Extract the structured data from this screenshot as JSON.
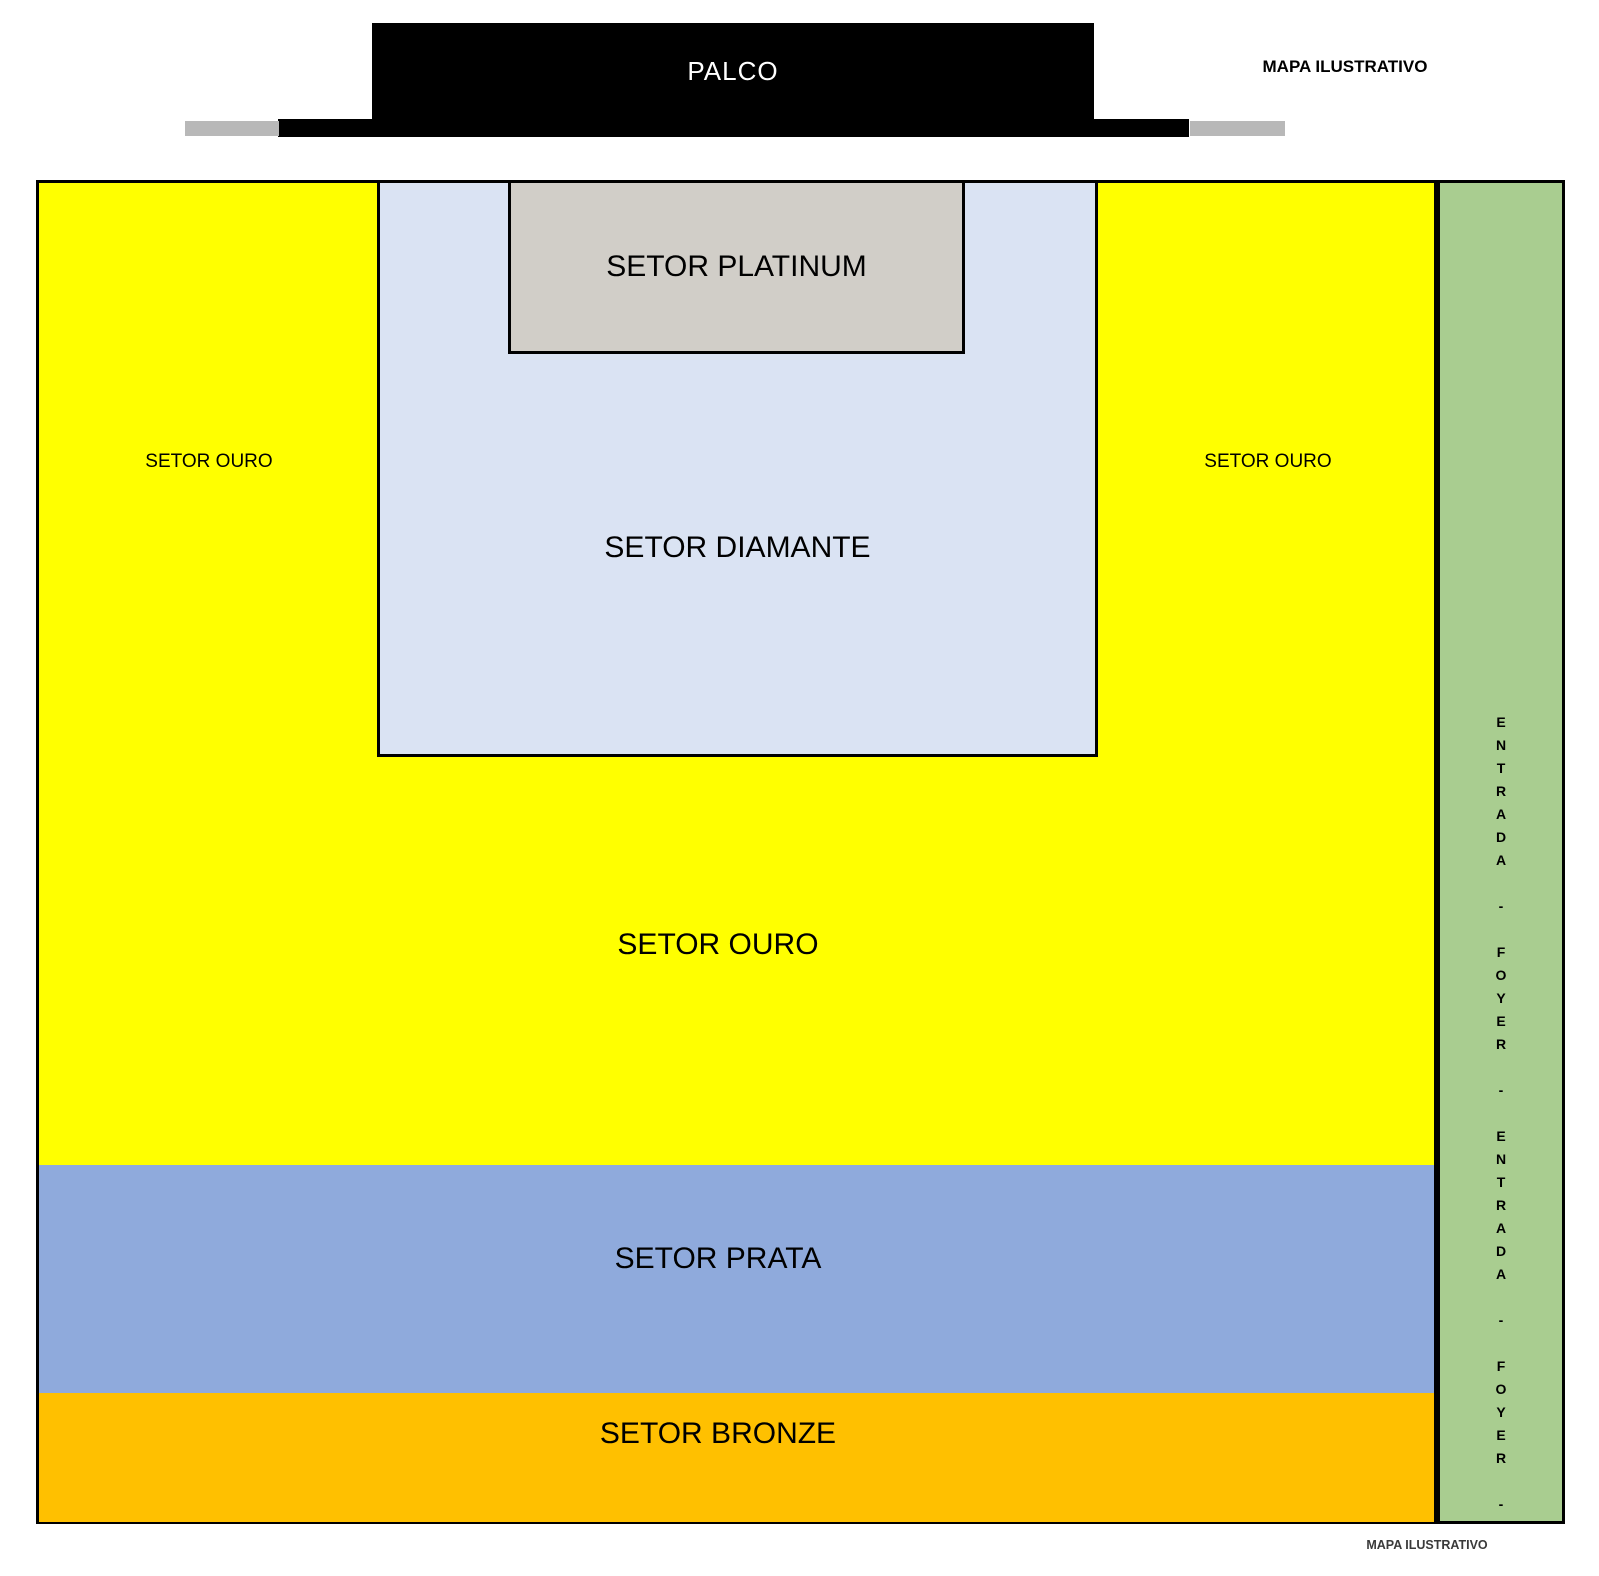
{
  "map_title_top": "MAPA ILUSTRATIVO",
  "map_title_bottom": "MAPA ILUSTRATIVO",
  "stage": {
    "label": "PALCO",
    "color": "#000000",
    "wing_color": "#b8b8b8"
  },
  "sectors": {
    "platinum": {
      "label": "SETOR PLATINUM",
      "color": "#d1cec8"
    },
    "diamante": {
      "label": "SETOR DIAMANTE",
      "color": "#dae3f3"
    },
    "ouro": {
      "label": "SETOR OURO",
      "color": "#ffff00"
    },
    "prata": {
      "label": "SETOR PRATA",
      "color": "#8faadc"
    },
    "bronze": {
      "label": "SETOR BRONZE",
      "color": "#ffc000"
    }
  },
  "ouro_side_labels": {
    "left": "SETOR OURO",
    "right": "SETOR OURO"
  },
  "entrance_strip": {
    "label": "ENTRADA - FOYER - ENTRADA - FOYER -",
    "vertical_text": "E\nN\nT\nR\nA\nD\nA\n \n-\n \nF\nO\nY\nE\nR\n \n-\n \nE\nN\nT\nR\nA\nD\nA\n \n-\n \nF\nO\nY\nE\nR\n \n-",
    "color": "#a9cd90"
  }
}
